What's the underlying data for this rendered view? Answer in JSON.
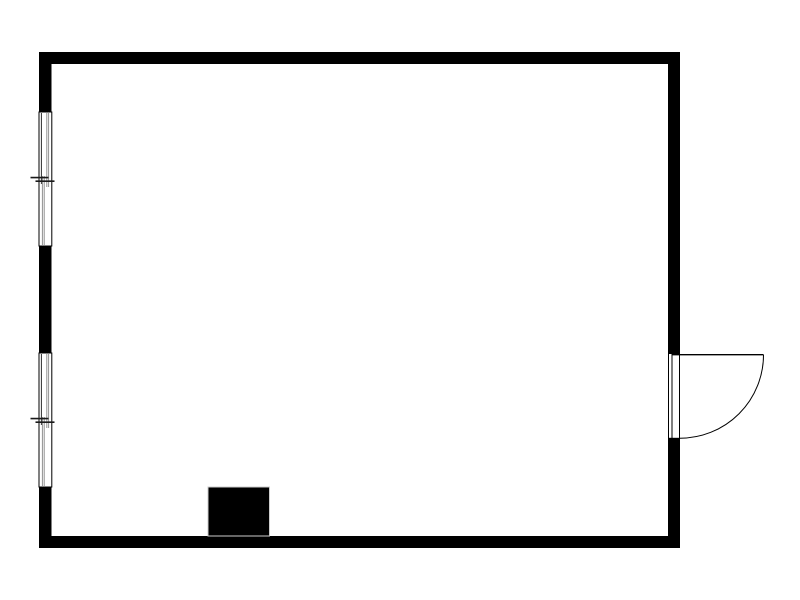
{
  "canvas": {
    "width": 800,
    "height": 600,
    "background": "#ffffff"
  },
  "palette": {
    "wall": "#000000",
    "window_frame": "#000000",
    "window_sash": "#2e2e2e",
    "window_glazing": "#909090",
    "window_tick": "#1a1a1a",
    "door": "#000000",
    "fireplace_fill": "#000000",
    "fireplace_outline": "#cccccc",
    "background": "#ffffff"
  },
  "plan": {
    "elements_summary": {
      "room": "single rectangular room",
      "windows": 2,
      "doors": 1,
      "door_swing": "outward to the right",
      "solid_block": "small filled block on interior of bottom wall"
    },
    "shapes": [
      {
        "name": "wall-top",
        "type": "rect",
        "x": 39,
        "y": 52,
        "w": 641,
        "h": 12,
        "fill": "#000000"
      },
      {
        "name": "wall-bottom",
        "type": "rect",
        "x": 39,
        "y": 536,
        "w": 641,
        "h": 12,
        "fill": "#000000"
      },
      {
        "name": "wall-left-upper",
        "type": "rect",
        "x": 39,
        "y": 52,
        "w": 12.5,
        "h": 60,
        "fill": "#000000"
      },
      {
        "name": "wall-left-middle",
        "type": "rect",
        "x": 39,
        "y": 246,
        "w": 12.5,
        "h": 107,
        "fill": "#000000"
      },
      {
        "name": "wall-left-lower",
        "type": "rect",
        "x": 39,
        "y": 487,
        "w": 12.5,
        "h": 61,
        "fill": "#000000"
      },
      {
        "name": "wall-right-upper",
        "type": "rect",
        "x": 668,
        "y": 52,
        "w": 12,
        "h": 302,
        "fill": "#000000"
      },
      {
        "name": "wall-right-lower",
        "type": "rect",
        "x": 668,
        "y": 438,
        "w": 12,
        "h": 110,
        "fill": "#000000"
      },
      {
        "name": "window-1-frame",
        "type": "rect",
        "x": 39,
        "y": 112,
        "w": 12.8,
        "h": 134,
        "fill": "#ffffff",
        "stroke": "#000000",
        "sw": 1
      },
      {
        "name": "window-1-sash-line",
        "type": "line",
        "x1": 41.4,
        "y1": 113,
        "x2": 41.4,
        "y2": 184,
        "stroke": "#2e2e2e",
        "sw": 1
      },
      {
        "name": "window-1-glazing-upper-a",
        "type": "line",
        "x1": 46.8,
        "y1": 113,
        "x2": 46.8,
        "y2": 187,
        "stroke": "#909090",
        "sw": 1
      },
      {
        "name": "window-1-glazing-upper-b",
        "type": "line",
        "x1": 48.6,
        "y1": 113,
        "x2": 48.6,
        "y2": 187,
        "stroke": "#909090",
        "sw": 1
      },
      {
        "name": "window-1-glazing-lower-a",
        "type": "line",
        "x1": 42.4,
        "y1": 176,
        "x2": 42.4,
        "y2": 245,
        "stroke": "#909090",
        "sw": 1
      },
      {
        "name": "window-1-glazing-lower-b",
        "type": "line",
        "x1": 44.2,
        "y1": 176,
        "x2": 44.2,
        "y2": 245,
        "stroke": "#909090",
        "sw": 1
      },
      {
        "name": "window-1-meeting-tick-a",
        "type": "line",
        "x1": 30.5,
        "y1": 177.6,
        "x2": 48.5,
        "y2": 177.6,
        "stroke": "#1a1a1a",
        "sw": 1.6
      },
      {
        "name": "window-1-meeting-tick-b",
        "type": "line",
        "x1": 35.5,
        "y1": 181.2,
        "x2": 54.5,
        "y2": 181.2,
        "stroke": "#1a1a1a",
        "sw": 1.6
      },
      {
        "name": "window-2-frame",
        "type": "rect",
        "x": 39,
        "y": 353,
        "w": 12.8,
        "h": 134,
        "fill": "#ffffff",
        "stroke": "#000000",
        "sw": 1
      },
      {
        "name": "window-2-sash-line",
        "type": "line",
        "x1": 41.4,
        "y1": 354,
        "x2": 41.4,
        "y2": 425,
        "stroke": "#2e2e2e",
        "sw": 1
      },
      {
        "name": "window-2-glazing-upper-a",
        "type": "line",
        "x1": 46.8,
        "y1": 354,
        "x2": 46.8,
        "y2": 428,
        "stroke": "#909090",
        "sw": 1
      },
      {
        "name": "window-2-glazing-upper-b",
        "type": "line",
        "x1": 48.6,
        "y1": 354,
        "x2": 48.6,
        "y2": 428,
        "stroke": "#909090",
        "sw": 1
      },
      {
        "name": "window-2-glazing-lower-a",
        "type": "line",
        "x1": 42.4,
        "y1": 417,
        "x2": 42.4,
        "y2": 486,
        "stroke": "#909090",
        "sw": 1
      },
      {
        "name": "window-2-glazing-lower-b",
        "type": "line",
        "x1": 44.2,
        "y1": 417,
        "x2": 44.2,
        "y2": 486,
        "stroke": "#909090",
        "sw": 1
      },
      {
        "name": "window-2-meeting-tick-a",
        "type": "line",
        "x1": 30.5,
        "y1": 418.6,
        "x2": 48.5,
        "y2": 418.6,
        "stroke": "#1a1a1a",
        "sw": 1.6
      },
      {
        "name": "window-2-meeting-tick-b",
        "type": "line",
        "x1": 35.5,
        "y1": 422.2,
        "x2": 54.5,
        "y2": 422.2,
        "stroke": "#1a1a1a",
        "sw": 1.6
      },
      {
        "name": "door-jamb",
        "type": "rect",
        "x": 668.5,
        "y": 353.5,
        "w": 11,
        "h": 84.8,
        "fill": "#ffffff",
        "stroke": "#000000",
        "sw": 1
      },
      {
        "name": "door-panel-line",
        "type": "line",
        "x1": 672,
        "y1": 354,
        "x2": 672,
        "y2": 438,
        "stroke": "#000000",
        "sw": 1
      },
      {
        "name": "door-leaf",
        "type": "line",
        "x1": 672,
        "y1": 354.7,
        "x2": 763.5,
        "y2": 354.7,
        "stroke": "#000000",
        "sw": 1.3
      },
      {
        "name": "door-swing-arc",
        "type": "path",
        "d": "M 763.5 354.7 A 83.5 83.5 0 0 1 680 438.2",
        "fill": "none",
        "stroke": "#000000",
        "sw": 1
      },
      {
        "name": "fireplace-block",
        "type": "rect",
        "x": 208,
        "y": 487,
        "w": 61.5,
        "h": 49,
        "fill": "#000000",
        "stroke": "#cccccc",
        "sw": 1
      }
    ]
  }
}
